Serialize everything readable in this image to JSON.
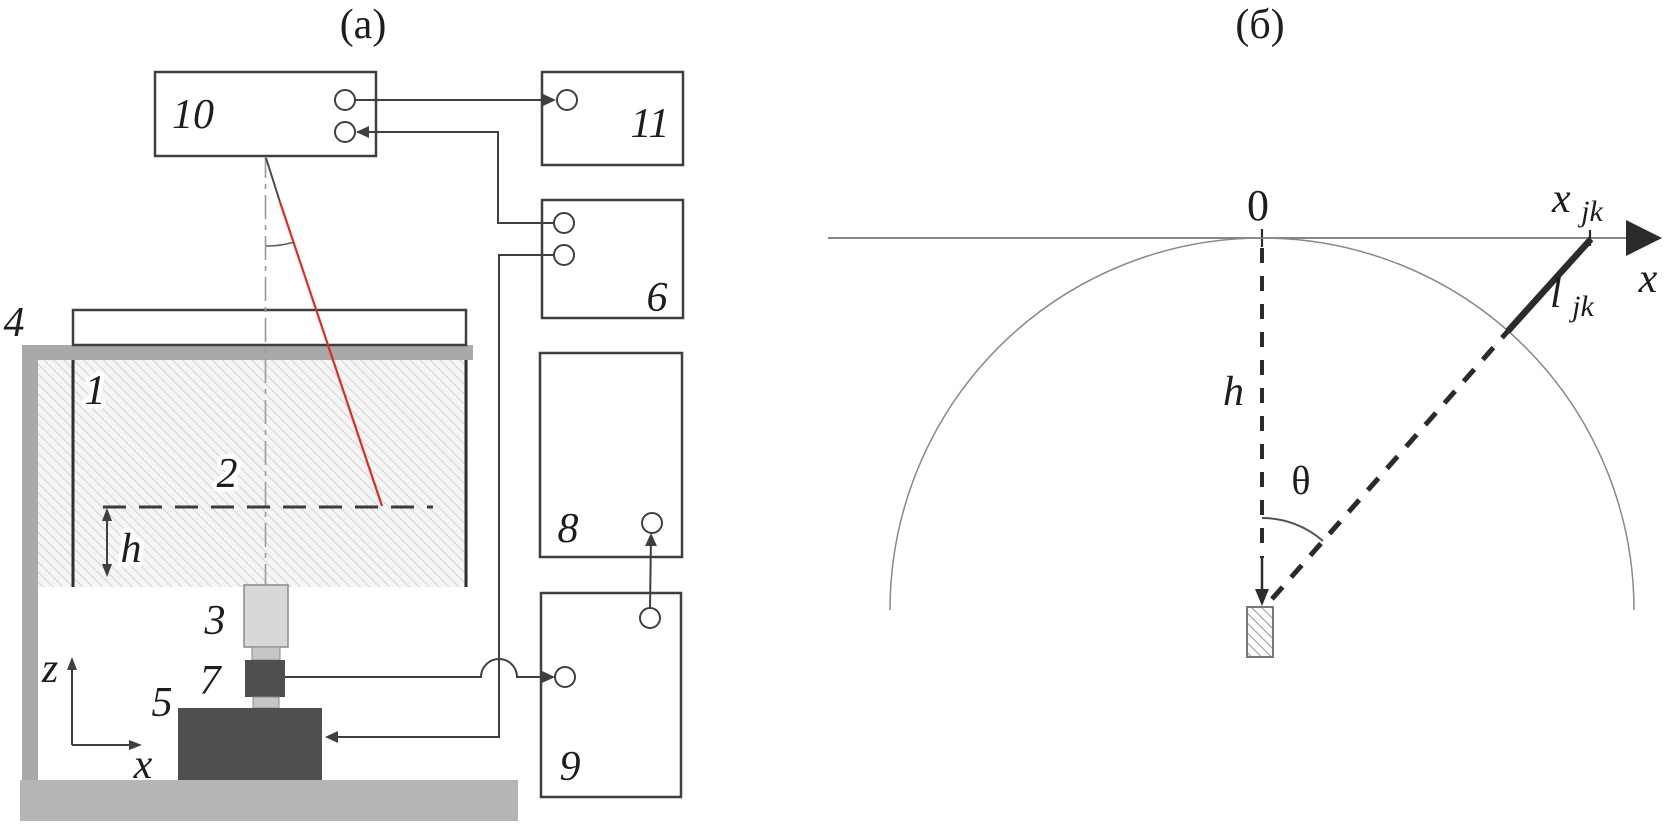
{
  "figure": {
    "caption_a": "(a)",
    "caption_b": "(б)"
  },
  "panel_a": {
    "labels": {
      "n1": "1",
      "n2": "2",
      "n3": "3",
      "n4": "4",
      "n5": "5",
      "n6": "6",
      "n7": "7",
      "n8": "8",
      "n9": "9",
      "n10": "10",
      "n11": "11",
      "depth_h": "h",
      "axis_z": "z",
      "axis_x": "x"
    },
    "colors": {
      "beam_red": "#df2b22",
      "line_dark": "#3f3f3f",
      "frame_gray": "#a9a9a9",
      "platform_gray": "#b5b5b5",
      "block_dark": "#4f4f4f",
      "block_light": "#d8d8d8"
    }
  },
  "panel_b": {
    "labels": {
      "origin": "0",
      "x_coord_main": "x",
      "x_coord_sub": "jk",
      "path_len_main": "l",
      "path_len_sub": "jk",
      "axis_x": "x",
      "depth_h": "h",
      "angle_theta": "θ"
    },
    "colors": {
      "geometry_dark": "#2b2b2b",
      "circle_gray": "#898989"
    }
  }
}
